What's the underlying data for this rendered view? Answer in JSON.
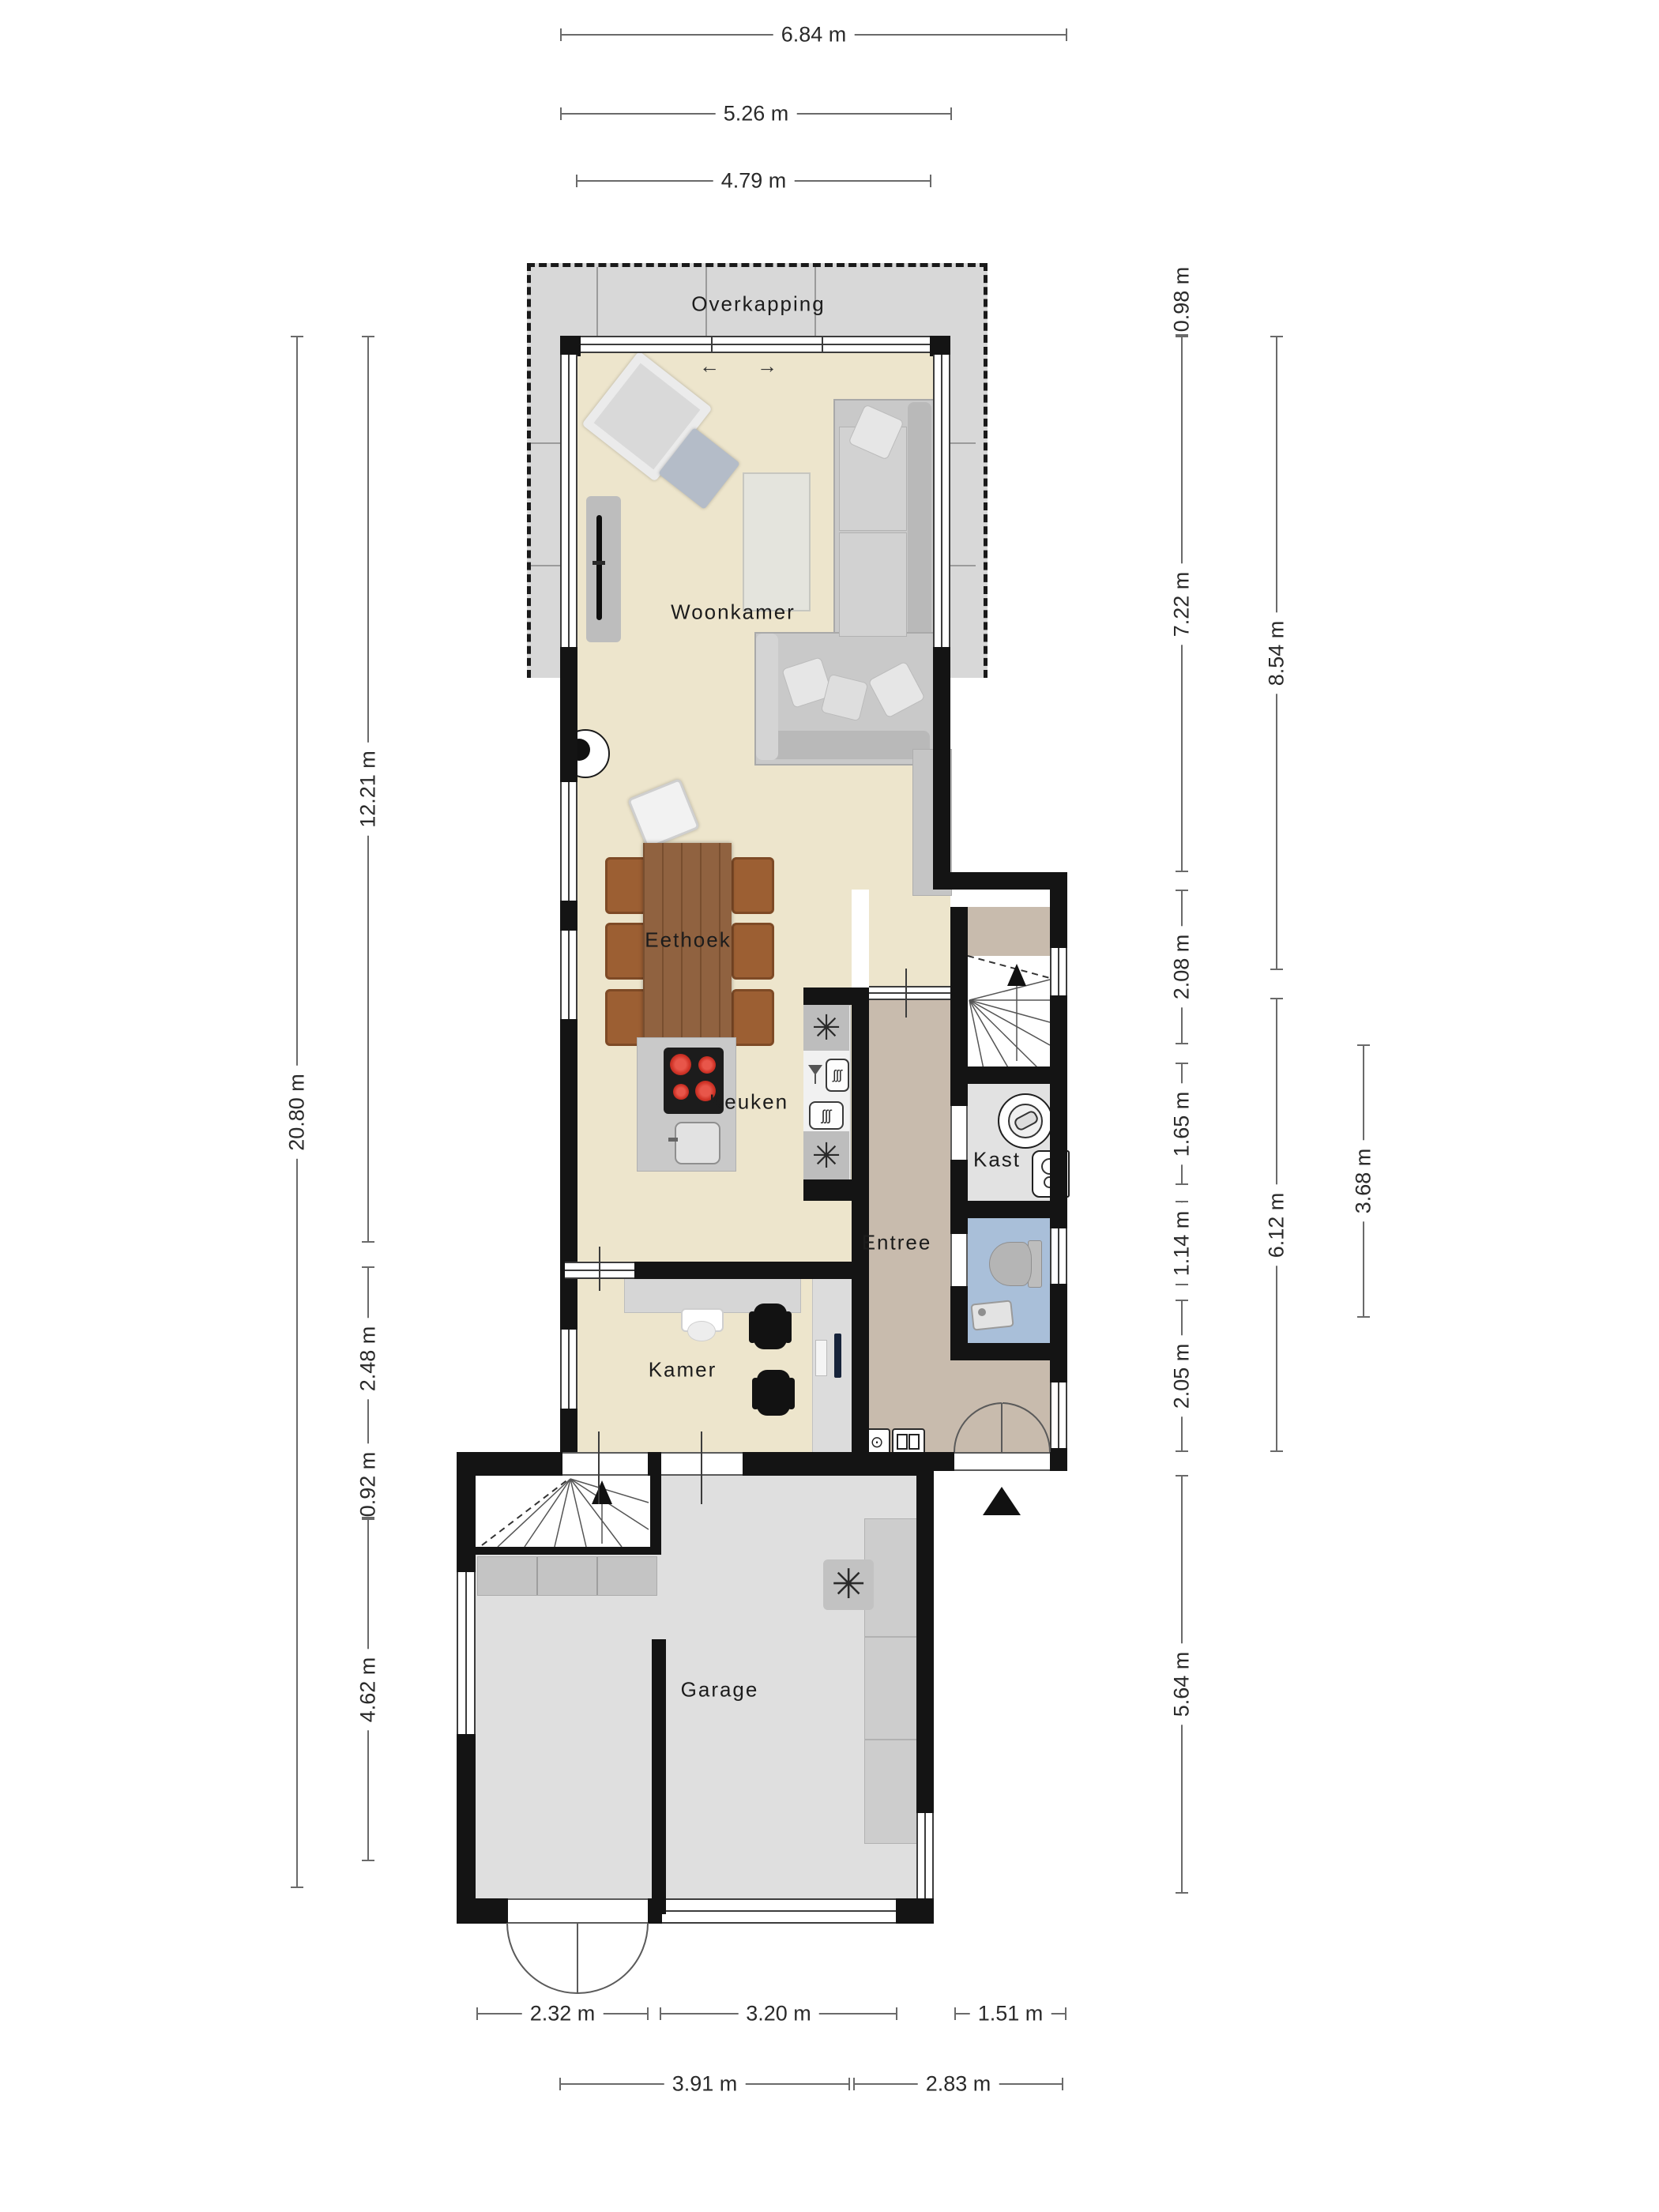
{
  "plan": {
    "rooms": {
      "overkapping": "Overkapping",
      "woonkamer": "Woonkamer",
      "eethoek": "Eethoek",
      "keuken": "Keuken",
      "entree": "Entree",
      "kast": "Kast",
      "kamer": "Kamer",
      "garage": "Garage"
    },
    "dims": {
      "top": {
        "d684": "6.84 m",
        "d526": "5.26 m",
        "d479": "4.79 m"
      },
      "left": {
        "d2080": "20.80 m",
        "d1221": "12.21 m",
        "d248": "2.48 m",
        "d092": "0.92 m",
        "d462": "4.62 m"
      },
      "right": {
        "d098": "0.98 m",
        "d722": "7.22 m",
        "d208": "2.08 m",
        "d165": "1.65 m",
        "d114": "1.14 m",
        "d205": "2.05 m",
        "d564": "5.64 m",
        "d854": "8.54 m",
        "d612": "6.12 m",
        "d368": "3.68 m"
      },
      "bottom": {
        "d232": "2.32 m",
        "d320": "3.20 m",
        "d151": "1.51 m",
        "d391": "3.91 m",
        "d283": "2.83 m"
      }
    },
    "icons": {
      "fan": "✳",
      "freezer_top": "✳",
      "freezer_bottom": "✳",
      "oven_coils": "ʃʃʃ",
      "dishwasher_coils": "ʃʃʃ",
      "slide_arrow_left": "←",
      "slide_arrow_right": "→",
      "meter_lamp": "⊙"
    },
    "colors": {
      "wall": "#141414",
      "living_floor": "#EDE5CC",
      "entree_floor": "#C8BBAD",
      "kast_floor": "#E2E2E2",
      "toilet_floor": "#A9BFD9",
      "garage_floor": "#DFDFDF",
      "overkapping": "#D8D8D8",
      "wood_table": "#8A5A36",
      "chair_brown": "#9C5F33",
      "hob_burner": "#D03327"
    }
  }
}
